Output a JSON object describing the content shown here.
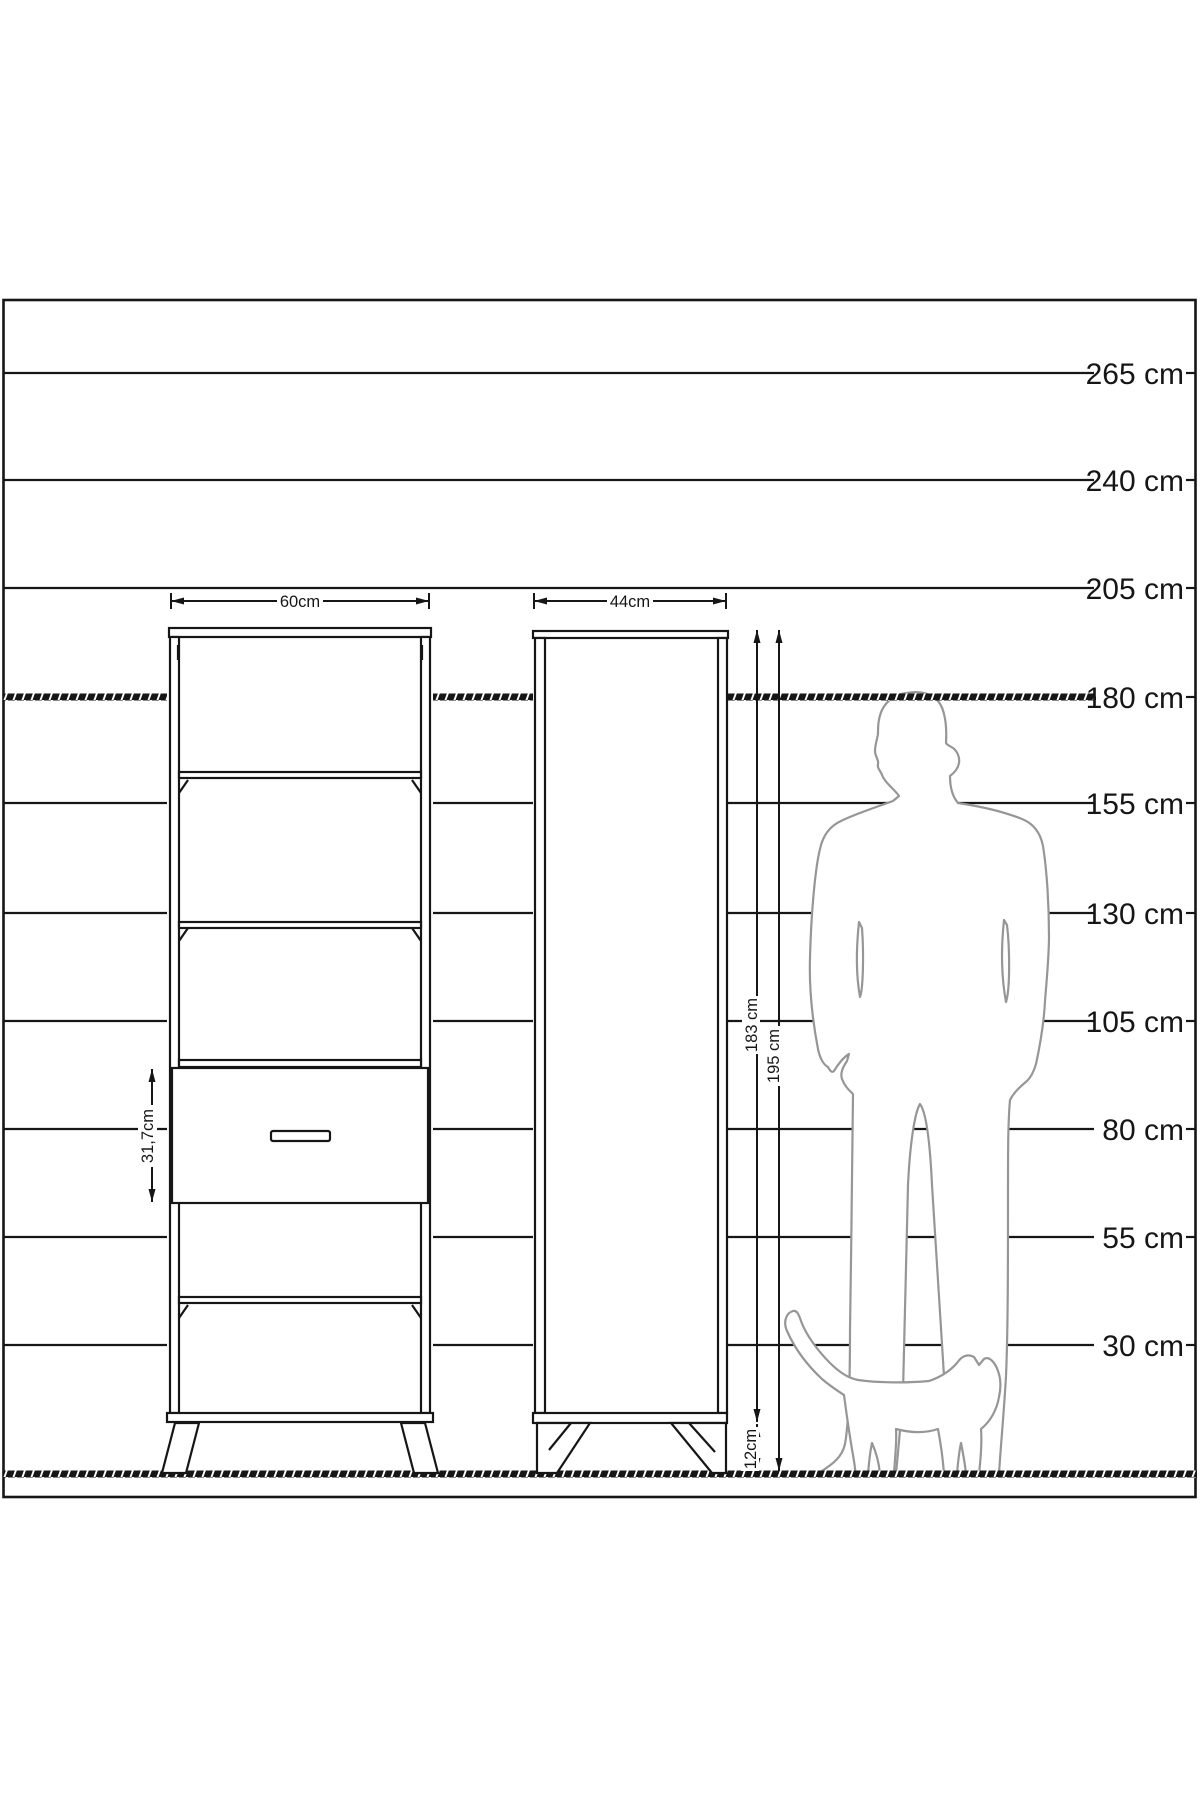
{
  "diagram": {
    "scale_labels": [
      "265 cm",
      "240 cm",
      "205 cm",
      "180 cm",
      "155 cm",
      "130 cm",
      "105 cm",
      "80 cm",
      "55 cm",
      "30 cm"
    ],
    "front_view": {
      "width_label": "60cm",
      "drawer_height_label": "31,7cm"
    },
    "side_view": {
      "width_label": "44cm",
      "body_height_label": "183 cm",
      "total_height_label": "195 cm",
      "leg_height_label": "12cm"
    },
    "colors": {
      "line": "#161616",
      "figure_outline": "#969696",
      "background": "#ffffff"
    }
  }
}
